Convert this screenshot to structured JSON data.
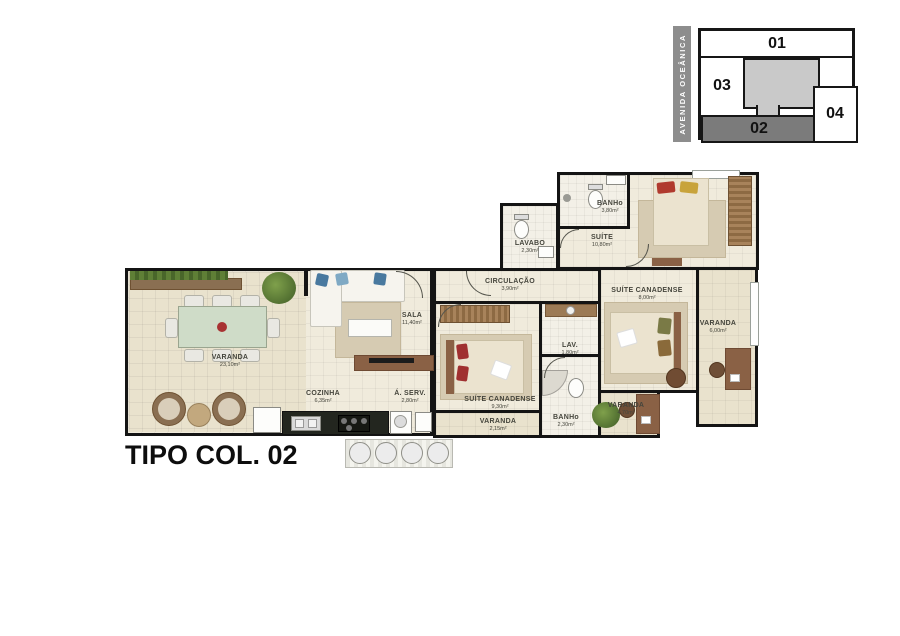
{
  "title": "TIPO COL. 02",
  "key_plan": {
    "street": "AVENIDA OCEÂNICA",
    "highlighted_unit": "02",
    "units": [
      {
        "label": "01"
      },
      {
        "label": "02"
      },
      {
        "label": "03"
      },
      {
        "label": "04"
      }
    ],
    "colors": {
      "highlight": "#7b7b7b",
      "core": "#c9c9c9",
      "street_bar": "#8d8d8d"
    }
  },
  "rooms": [
    {
      "name": "VARANDA",
      "area": "23,10m²"
    },
    {
      "name": "SALA",
      "area": "11,40m²"
    },
    {
      "name": "COZINHA",
      "area": "6,35m²"
    },
    {
      "name": "Á. SERV.",
      "area": "2,80m²"
    },
    {
      "name": "CIRCULAÇÃO",
      "area": "3,90m²"
    },
    {
      "name": "LAVABO",
      "area": "2,30m²"
    },
    {
      "name": "BANHo",
      "area": "3,80m²"
    },
    {
      "name": "SUÍTE",
      "area": "10,80m²"
    },
    {
      "name": "SUÍTE CANADENSE",
      "area": "9,30m²"
    },
    {
      "name": "VARANDA",
      "area": "2,15m²"
    },
    {
      "name": "LAV.",
      "area": "1,80m²"
    },
    {
      "name": "BANHo",
      "area": "2,30m²"
    },
    {
      "name": "SUÍTE CANADENSE",
      "area": "8,00m²"
    },
    {
      "name": "VARANDA",
      "area": "6,00m²"
    },
    {
      "name": "VARANDA",
      "area": "4,70m²"
    }
  ],
  "palette": {
    "wall": "#141414",
    "floor": "#f0ebdc",
    "balcony_floor": "#e9e2cd",
    "wood": "#8a6145"
  }
}
